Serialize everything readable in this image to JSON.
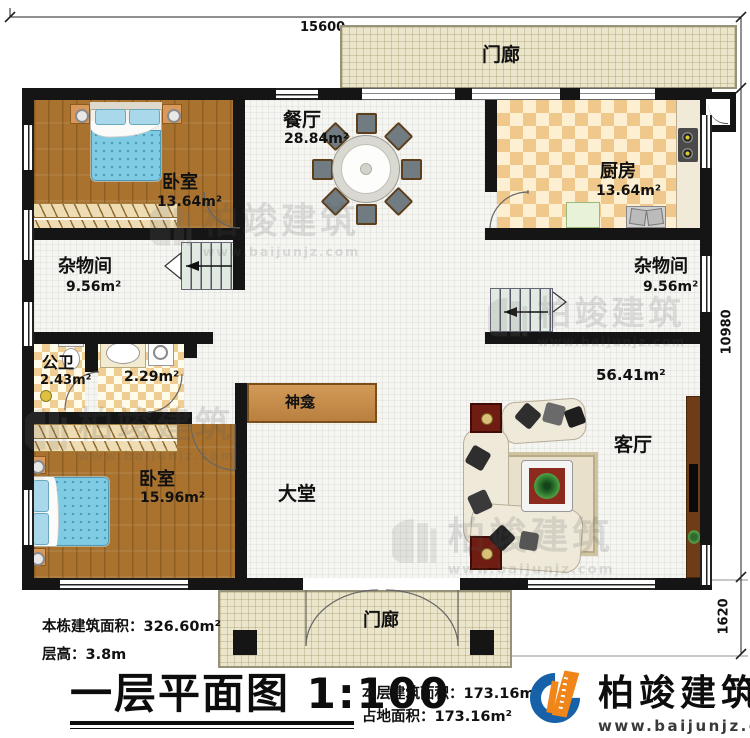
{
  "plan": {
    "dimensions": {
      "top": "15600",
      "right_main": "10980",
      "right_porch": "1620"
    },
    "rooms": {
      "porch_top": {
        "name": "门廊"
      },
      "dining": {
        "name": "餐厅",
        "area": "28.84m²"
      },
      "kitchen": {
        "name": "厨房",
        "area": "13.64m²"
      },
      "bedroom_top": {
        "name": "卧室",
        "area": "13.64m²"
      },
      "storage_left": {
        "name": "杂物间",
        "area": "9.56m²"
      },
      "storage_right": {
        "name": "杂物间",
        "area": "9.56m²"
      },
      "bathroom": {
        "name": "公卫",
        "area": "2.43m²"
      },
      "washroom": {
        "area": "2.29m²"
      },
      "shrine": {
        "name": "神龛"
      },
      "hall": {
        "name": "大堂"
      },
      "living": {
        "name": "客厅",
        "area": "56.41m²"
      },
      "bedroom_bottom": {
        "name": "卧室",
        "area": "15.96m²"
      },
      "porch_bottom": {
        "name": "门廊"
      }
    }
  },
  "annotations": {
    "building_area": {
      "label": "本栋建筑面积：",
      "value": "326.60m²"
    },
    "floor_height": {
      "label": "层高：",
      "value": "3.8m"
    },
    "floor_area": {
      "label": "本层建筑面积：",
      "value": "173.16m²"
    },
    "footprint": {
      "label": "占地面积：",
      "value": "173.16m²"
    }
  },
  "title_block": {
    "title": "一层平面图",
    "scale": "1:100"
  },
  "logo": {
    "name": "柏竣建筑",
    "url": "www.baijunjz.com"
  },
  "watermark": {
    "name": "柏竣建筑",
    "url": "www.baijunjz.com"
  },
  "colors": {
    "accent_blue": "#1661a8",
    "accent_orange": "#f08519",
    "wall": "#151515",
    "wood": "#a9732f",
    "tile_orange": "#f0c88c",
    "stair_green": "#e0eae0"
  }
}
